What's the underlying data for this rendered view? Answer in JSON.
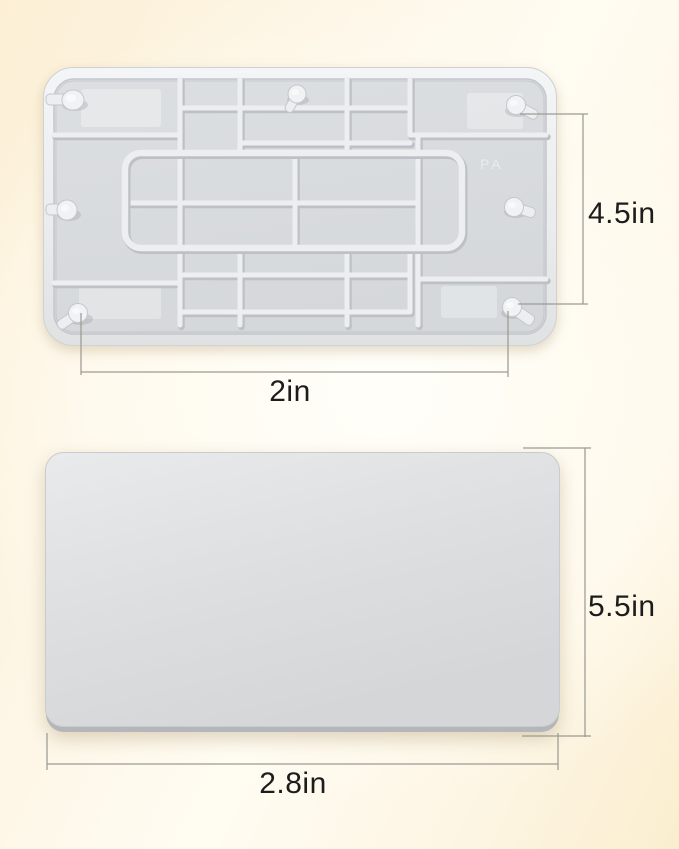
{
  "product_diagram": {
    "back_view": {
      "dim_height": "4.5in",
      "dim_width": "2in",
      "mold_mark": "PA"
    },
    "front_view": {
      "dim_height": "5.5in",
      "dim_width": "2.8in"
    },
    "colors": {
      "background_warm": "#fbeecf",
      "background_light": "#fffdf6",
      "plate_face": "#d9dcdf",
      "plate_rib_highlight": "#eceef0",
      "plate_rib_shadow": "#bdc1c5",
      "plate_edge_shadow": "#b4b7ba",
      "dimension_line": "#9b9b94",
      "dimension_text": "#1c1c1c"
    }
  }
}
